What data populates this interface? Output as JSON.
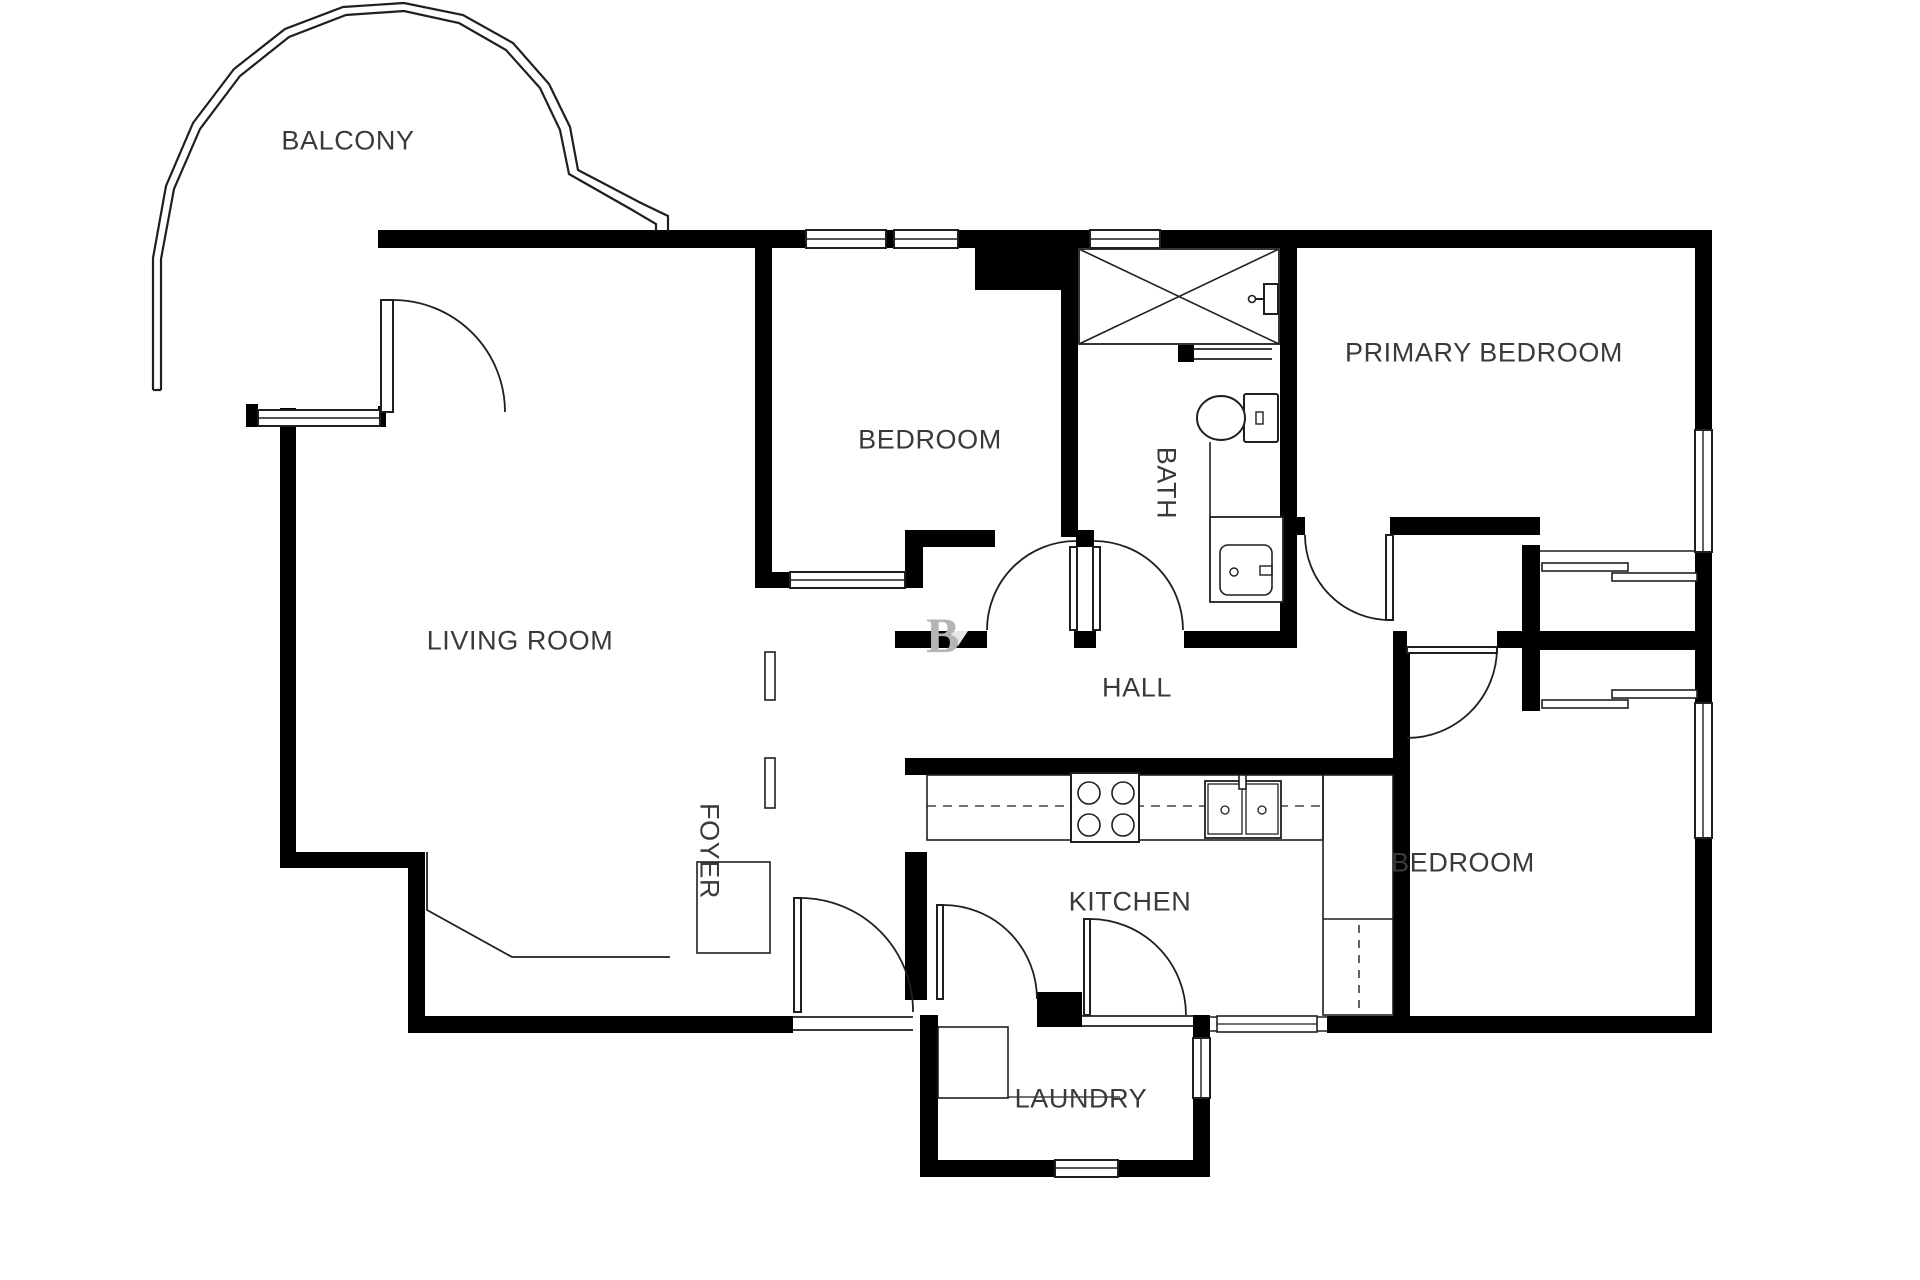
{
  "page": {
    "title": "Apartment floor plan",
    "background": "#ffffff"
  },
  "floorplan": {
    "colors": {
      "wall": "#000000",
      "line": "#1f1f1f",
      "label": "#3a3a3a",
      "watermark": "#b5b5b5",
      "background": "#ffffff"
    },
    "rooms": [
      {
        "id": "balcony",
        "label": "BALCONY",
        "x": 348,
        "y": 141,
        "rotate": 0
      },
      {
        "id": "living-room",
        "label": "LIVING ROOM",
        "x": 520,
        "y": 641,
        "rotate": 0
      },
      {
        "id": "bedroom-top",
        "label": "BEDROOM",
        "x": 930,
        "y": 440,
        "rotate": 0
      },
      {
        "id": "bath",
        "label": "BATH",
        "x": 1166,
        "y": 483,
        "rotate": 90
      },
      {
        "id": "primary-bedroom",
        "label": "PRIMARY BEDROOM",
        "x": 1484,
        "y": 353,
        "rotate": 0
      },
      {
        "id": "hall",
        "label": "HALL",
        "x": 1137,
        "y": 688,
        "rotate": 0
      },
      {
        "id": "foyer",
        "label": "FOYER",
        "x": 709,
        "y": 851,
        "rotate": 90
      },
      {
        "id": "kitchen",
        "label": "KITCHEN",
        "x": 1130,
        "y": 902,
        "rotate": 0
      },
      {
        "id": "bedroom-bottom",
        "label": "BEDROOM",
        "x": 1463,
        "y": 863,
        "rotate": 0
      },
      {
        "id": "laundry",
        "label": "LAUNDRY",
        "x": 1081,
        "y": 1099,
        "rotate": 0
      }
    ],
    "watermark": {
      "text": "B",
      "x": 926,
      "y": 652
    }
  }
}
